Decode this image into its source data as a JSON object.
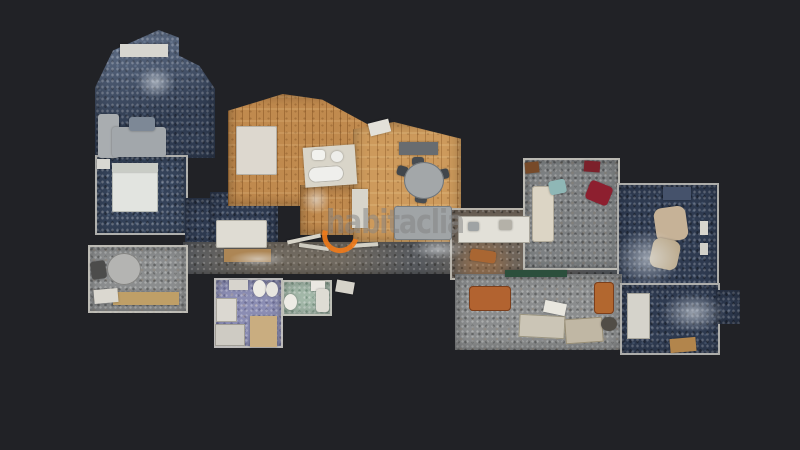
{
  "scene": {
    "background_color": "#212226",
    "view": "top-down 3d scan floor plan"
  },
  "watermark": {
    "text": "habitaclia",
    "text_color": "rgba(132,132,132,0.52)",
    "logo_color": "#ef7a1a"
  },
  "floorplan": {
    "rooms": [
      {
        "id": "living-room",
        "x": 95,
        "y": 30,
        "w": 120,
        "h": 128,
        "floor": "blue-light",
        "clip": "polygon(0% 45%, 15% 16%, 53% 0%, 70% 6%, 70% 20%, 87% 28%, 100% 46%, 100% 100%, 0% 100%)"
      },
      {
        "id": "bedroom-1",
        "x": 95,
        "y": 155,
        "w": 93,
        "h": 80,
        "floor": "blue",
        "wall": true
      },
      {
        "id": "hall",
        "x": 185,
        "y": 198,
        "w": 33,
        "h": 50,
        "floor": "blue-dark"
      },
      {
        "id": "bedroom-2",
        "x": 210,
        "y": 192,
        "w": 68,
        "h": 62,
        "floor": "blue-dark"
      },
      {
        "id": "suite-wood",
        "x": 228,
        "y": 94,
        "w": 152,
        "h": 112,
        "floor": "wood",
        "clip": "polygon(0% 15%, 36% 0%, 62% 5%, 100% 33%, 100% 100%, 0% 100%)"
      },
      {
        "id": "suite-hall-wood",
        "x": 300,
        "y": 185,
        "w": 60,
        "h": 50,
        "floor": "wood"
      },
      {
        "id": "dining-room",
        "x": 353,
        "y": 122,
        "w": 108,
        "h": 120,
        "floor": "wood-light",
        "clip": "polygon(0% 6%, 38% 0%, 100% 14%, 100% 100%, 0% 100%)"
      },
      {
        "id": "corridor",
        "x": 183,
        "y": 242,
        "w": 465,
        "h": 32,
        "floor": "corridor"
      },
      {
        "id": "kitchen",
        "x": 450,
        "y": 208,
        "w": 85,
        "h": 72,
        "floor": "brown",
        "wall": true
      },
      {
        "id": "salon",
        "x": 523,
        "y": 158,
        "w": 97,
        "h": 112,
        "floor": "gray",
        "wall": true
      },
      {
        "id": "bedroom-3",
        "x": 617,
        "y": 183,
        "w": 102,
        "h": 114,
        "floor": "blue-dark",
        "wall": true
      },
      {
        "id": "office",
        "x": 455,
        "y": 274,
        "w": 167,
        "h": 76,
        "floor": "gray-light"
      },
      {
        "id": "bedroom-4",
        "x": 620,
        "y": 283,
        "w": 100,
        "h": 72,
        "floor": "blue-dark",
        "wall": true
      },
      {
        "id": "bedroom-4-annex",
        "x": 716,
        "y": 290,
        "w": 24,
        "h": 34,
        "floor": "blue-dark"
      },
      {
        "id": "breakfast-room",
        "x": 88,
        "y": 245,
        "w": 100,
        "h": 68,
        "floor": "gray-light",
        "wall": true
      },
      {
        "id": "bathroom-1",
        "x": 214,
        "y": 278,
        "w": 69,
        "h": 70,
        "floor": "purple",
        "wall": true
      },
      {
        "id": "bathroom-2",
        "x": 282,
        "y": 280,
        "w": 50,
        "h": 36,
        "floor": "green",
        "wall": true
      }
    ],
    "furniture": [
      {
        "name": "window-sill",
        "x": 120,
        "y": 44,
        "w": 48,
        "h": 13,
        "color": "#d7d6d0"
      },
      {
        "name": "sofa-chaise",
        "x": 98,
        "y": 114,
        "w": 21,
        "h": 44,
        "color": "#a9adb0",
        "radius": "3px"
      },
      {
        "name": "sofa-main",
        "x": 112,
        "y": 127,
        "w": 54,
        "h": 30,
        "color": "#a2a7ab",
        "radius": "3px"
      },
      {
        "name": "ottoman",
        "x": 129,
        "y": 117,
        "w": 26,
        "h": 14,
        "color": "#7d8896",
        "radius": "3px"
      },
      {
        "name": "bed-double",
        "x": 112,
        "y": 163,
        "w": 46,
        "h": 49,
        "color": "#e2e4e0",
        "radius": "2px",
        "border": "#b9bcb6"
      },
      {
        "name": "bed-pillows",
        "x": 112,
        "y": 163,
        "w": 46,
        "h": 9,
        "color": "#c9ccc6"
      },
      {
        "name": "nightstand",
        "x": 97,
        "y": 159,
        "w": 13,
        "h": 10,
        "color": "#d9d8d2"
      },
      {
        "name": "bed-suite",
        "x": 236,
        "y": 126,
        "w": 41,
        "h": 49,
        "color": "#ddd8cf",
        "radius": "2px",
        "border": "#b5b0a6"
      },
      {
        "name": "ensuite-floor",
        "x": 304,
        "y": 146,
        "w": 52,
        "h": 40,
        "color": "#d9d5c9",
        "rotate": -4
      },
      {
        "name": "bathtub",
        "x": 308,
        "y": 166,
        "w": 36,
        "h": 16,
        "color": "#efefec",
        "radius": "8px",
        "rotate": -4,
        "border": "#b9b6ac"
      },
      {
        "name": "ensuite-sink",
        "x": 312,
        "y": 150,
        "w": 13,
        "h": 10,
        "color": "#f2f2ee",
        "radius": "3px"
      },
      {
        "name": "ensuite-toilet",
        "x": 331,
        "y": 151,
        "w": 12,
        "h": 11,
        "color": "#eeeeea",
        "radius": "50%"
      },
      {
        "name": "bed-small",
        "x": 216,
        "y": 220,
        "w": 51,
        "h": 28,
        "color": "#dfdcd3",
        "radius": "2px",
        "border": "#b7b4aa"
      },
      {
        "name": "rug-tan",
        "x": 224,
        "y": 249,
        "w": 47,
        "h": 13,
        "color": "#ad8655"
      },
      {
        "name": "ac-unit",
        "x": 369,
        "y": 121,
        "w": 21,
        "h": 13,
        "color": "#e3e1d9",
        "rotate": -14
      },
      {
        "name": "sideboard",
        "x": 399,
        "y": 142,
        "w": 39,
        "h": 13,
        "color": "#686c70"
      },
      {
        "name": "dining-chair-1",
        "x": 397,
        "y": 166,
        "w": 11,
        "h": 10,
        "color": "#41464b",
        "radius": "3px",
        "rotate": 15
      },
      {
        "name": "dining-chair-2",
        "x": 438,
        "y": 169,
        "w": 11,
        "h": 10,
        "color": "#41464b",
        "radius": "3px",
        "rotate": -12
      },
      {
        "name": "dining-chair-3",
        "x": 412,
        "y": 157,
        "w": 12,
        "h": 9,
        "color": "#474c51",
        "radius": "3px"
      },
      {
        "name": "dining-chair-4",
        "x": 415,
        "y": 194,
        "w": 12,
        "h": 9,
        "color": "#474c51",
        "radius": "3px",
        "rotate": 8
      },
      {
        "name": "dining-table",
        "x": 404,
        "y": 162,
        "w": 40,
        "h": 37,
        "color": "#a3a7a9",
        "radius": "50%",
        "border": "#6f7478"
      },
      {
        "name": "sofa-dining",
        "x": 394,
        "y": 206,
        "w": 58,
        "h": 34,
        "color": "#a0a4a6",
        "radius": "3px",
        "border": "#787d80"
      },
      {
        "name": "wardrobe-white",
        "x": 352,
        "y": 189,
        "w": 16,
        "h": 39,
        "color": "#d8d5cb"
      },
      {
        "name": "kitchen-counter",
        "x": 458,
        "y": 216,
        "w": 72,
        "h": 27,
        "color": "#e2e0d8",
        "border": "#a9a69c"
      },
      {
        "name": "kitchen-sink",
        "x": 468,
        "y": 222,
        "w": 11,
        "h": 9,
        "color": "#9fa3a4",
        "radius": "2px"
      },
      {
        "name": "kitchen-hob",
        "x": 499,
        "y": 220,
        "w": 13,
        "h": 10,
        "color": "#b4b1a8",
        "radius": "2px"
      },
      {
        "name": "kitchen-crate",
        "x": 470,
        "y": 250,
        "w": 26,
        "h": 12,
        "color": "#a96632",
        "radius": "3px",
        "rotate": 8
      },
      {
        "name": "sofa-cream",
        "x": 532,
        "y": 186,
        "w": 22,
        "h": 56,
        "color": "#dcd5c5",
        "radius": "3px",
        "border": "#b3ac9b"
      },
      {
        "name": "chair-teal",
        "x": 549,
        "y": 180,
        "w": 17,
        "h": 14,
        "color": "#8fb7b6",
        "radius": "3px",
        "rotate": -12
      },
      {
        "name": "armchair-red",
        "x": 587,
        "y": 183,
        "w": 24,
        "h": 20,
        "color": "#8d1f2f",
        "radius": "4px",
        "rotate": 22
      },
      {
        "name": "cabinet-red",
        "x": 584,
        "y": 161,
        "w": 16,
        "h": 11,
        "color": "#7c212b",
        "rotate": 4
      },
      {
        "name": "cabinet-brown",
        "x": 525,
        "y": 162,
        "w": 14,
        "h": 11,
        "color": "#774a29",
        "rotate": -6
      },
      {
        "name": "tv-unit",
        "x": 663,
        "y": 187,
        "w": 28,
        "h": 13,
        "color": "#45526b"
      },
      {
        "name": "armchair-tan-1",
        "x": 655,
        "y": 207,
        "w": 32,
        "h": 34,
        "color": "#c6b297",
        "radius": "8px",
        "rotate": -8
      },
      {
        "name": "armchair-tan-2",
        "x": 651,
        "y": 239,
        "w": 28,
        "h": 30,
        "color": "#bcab8e",
        "radius": "8px",
        "rotate": 12
      },
      {
        "name": "door-leaf-1",
        "x": 700,
        "y": 221,
        "w": 8,
        "h": 14,
        "color": "#d8d6ce"
      },
      {
        "name": "door-leaf-2",
        "x": 700,
        "y": 243,
        "w": 8,
        "h": 12,
        "color": "#d3d1c9"
      },
      {
        "name": "planter-strip",
        "x": 505,
        "y": 270,
        "w": 62,
        "h": 7,
        "color": "#2c4f3c"
      },
      {
        "name": "sofa-orange-1",
        "x": 469,
        "y": 286,
        "w": 42,
        "h": 25,
        "color": "#b26330",
        "radius": "4px",
        "border": "#7c3f1c"
      },
      {
        "name": "sofa-orange-2",
        "x": 594,
        "y": 282,
        "w": 20,
        "h": 32,
        "color": "#b2672f",
        "radius": "4px",
        "border": "#7c3f1c"
      },
      {
        "name": "desk-1",
        "x": 519,
        "y": 315,
        "w": 46,
        "h": 23,
        "color": "#cbc5b6",
        "rotate": 3,
        "border": "#9a947f"
      },
      {
        "name": "desk-2",
        "x": 565,
        "y": 318,
        "w": 38,
        "h": 25,
        "color": "#c0b7a4",
        "rotate": -4,
        "border": "#968c74"
      },
      {
        "name": "papers",
        "x": 544,
        "y": 302,
        "w": 22,
        "h": 12,
        "color": "#e9e7df",
        "rotate": 12
      },
      {
        "name": "office-chair",
        "x": 601,
        "y": 317,
        "w": 16,
        "h": 14,
        "color": "#514d46",
        "radius": "50%"
      },
      {
        "name": "wardrobe-right",
        "x": 627,
        "y": 293,
        "w": 23,
        "h": 46,
        "color": "#d5d3cb",
        "border": "#a7a59b"
      },
      {
        "name": "bench-tan",
        "x": 670,
        "y": 338,
        "w": 26,
        "h": 14,
        "color": "#b2854c",
        "rotate": -5
      },
      {
        "name": "round-table",
        "x": 107,
        "y": 253,
        "w": 34,
        "h": 32,
        "color": "#b4b4b2",
        "radius": "50%",
        "border": "#838381"
      },
      {
        "name": "chair-dark",
        "x": 91,
        "y": 261,
        "w": 15,
        "h": 18,
        "color": "#4c4c4b",
        "radius": "3px",
        "rotate": -8
      },
      {
        "name": "counter-tan",
        "x": 113,
        "y": 292,
        "w": 66,
        "h": 13,
        "color": "#bf9f67"
      },
      {
        "name": "clutter-white",
        "x": 94,
        "y": 289,
        "w": 24,
        "h": 14,
        "color": "#dbd8d0",
        "rotate": -5
      },
      {
        "name": "toilet",
        "x": 253,
        "y": 280,
        "w": 13,
        "h": 17,
        "color": "#edebe5",
        "radius": "50%"
      },
      {
        "name": "bidet",
        "x": 266,
        "y": 282,
        "w": 12,
        "h": 15,
        "color": "#e7e5df",
        "radius": "50%"
      },
      {
        "name": "sink-counter",
        "x": 229,
        "y": 280,
        "w": 19,
        "h": 10,
        "color": "#d7d4cd"
      },
      {
        "name": "washer",
        "x": 216,
        "y": 298,
        "w": 21,
        "h": 24,
        "color": "#dbd8d1",
        "border": "#a8a59d"
      },
      {
        "name": "shower-tray",
        "x": 215,
        "y": 324,
        "w": 30,
        "h": 22,
        "color": "#cecbc3",
        "border": "#a09d95"
      },
      {
        "name": "wood-mat",
        "x": 250,
        "y": 316,
        "w": 27,
        "h": 31,
        "color": "#c9ad80"
      },
      {
        "name": "sink-green",
        "x": 311,
        "y": 281,
        "w": 14,
        "h": 10,
        "color": "#eae8e2"
      },
      {
        "name": "toilet-green",
        "x": 284,
        "y": 294,
        "w": 13,
        "h": 16,
        "color": "#edebe5",
        "radius": "50%"
      },
      {
        "name": "tub-green",
        "x": 316,
        "y": 289,
        "w": 13,
        "h": 23,
        "color": "#dedcd4",
        "radius": "3px"
      },
      {
        "name": "fixture-loose",
        "x": 336,
        "y": 281,
        "w": 18,
        "h": 12,
        "color": "#d6d3ca",
        "rotate": 10
      },
      {
        "name": "debris-stick-1",
        "x": 287,
        "y": 237,
        "w": 34,
        "h": 4,
        "color": "#d7d4c9",
        "rotate": -12
      },
      {
        "name": "debris-stick-2",
        "x": 299,
        "y": 245,
        "w": 30,
        "h": 4,
        "color": "#cecbc0",
        "rotate": 8
      },
      {
        "name": "debris-stick-3",
        "x": 352,
        "y": 243,
        "w": 26,
        "h": 4,
        "color": "#d3d0c5",
        "rotate": -4
      }
    ],
    "mist": [
      {
        "x": 398,
        "y": 234,
        "w": 80,
        "h": 30
      },
      {
        "x": 600,
        "y": 218,
        "w": 95,
        "h": 80
      },
      {
        "x": 648,
        "y": 285,
        "w": 90,
        "h": 55
      },
      {
        "x": 218,
        "y": 248,
        "w": 80,
        "h": 22
      },
      {
        "x": 296,
        "y": 180,
        "w": 40,
        "h": 40
      },
      {
        "x": 128,
        "y": 60,
        "w": 55,
        "h": 45
      }
    ]
  }
}
